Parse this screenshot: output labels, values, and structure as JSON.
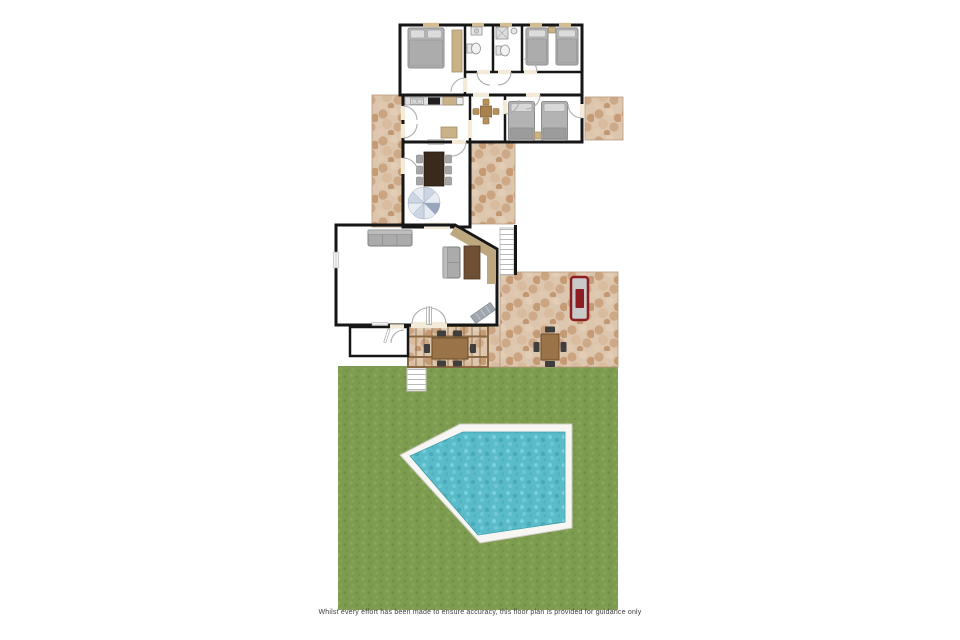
{
  "page": {
    "background": "#FFFFFF"
  },
  "disclaimer": "Whilst every effort has been made to ensure accuracy, this floor plan is provided for guidance only",
  "colors": {
    "page-bg": "#FFFFFF",
    "floor": "#F3EBD8",
    "wall": "#161616",
    "stone-base": "#DCC6AE",
    "grass-base": "#7E9C4F",
    "water-base": "#5ABBC9",
    "pool-deck": "#F7F6F2",
    "furniture-gray": "#ABABAB",
    "wood-dark": "#3A2A1C",
    "wood-mid": "#9A7448",
    "tan": "#C9B288",
    "bbq-red": "#8E1D22",
    "stair-blue": "#CBD5E3"
  },
  "elements": {
    "rooms": [
      {
        "name": "double-bedroom"
      },
      {
        "name": "bathroom-1"
      },
      {
        "name": "bathroom-2"
      },
      {
        "name": "twin-bedroom-upper"
      },
      {
        "name": "hallway"
      },
      {
        "name": "kitchen"
      },
      {
        "name": "breakfast-area"
      },
      {
        "name": "twin-bedroom-lower"
      },
      {
        "name": "dining-room"
      },
      {
        "name": "living-room"
      },
      {
        "name": "porch"
      }
    ],
    "features": [
      {
        "name": "spiral-staircase"
      },
      {
        "name": "stone-terraces"
      },
      {
        "name": "pergola-dining-area"
      },
      {
        "name": "terrace-dining-table"
      },
      {
        "name": "barbecue"
      },
      {
        "name": "exterior-steps"
      },
      {
        "name": "garden-steps"
      },
      {
        "name": "lawn"
      },
      {
        "name": "swimming-pool"
      }
    ]
  }
}
